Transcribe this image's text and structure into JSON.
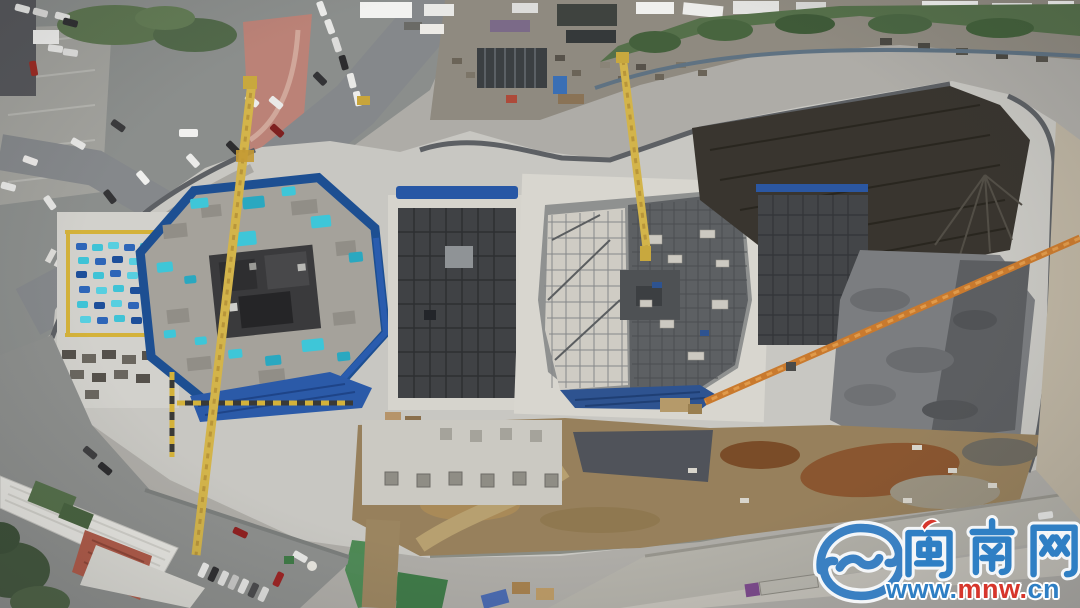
{
  "watermark": {
    "logo_icon": "mnw-swirl-logo",
    "site_name": "闽南网",
    "url_parts": {
      "www": "www.",
      "mnw": "mnw.",
      "cn": "cn"
    },
    "brand_blue": "#2f7fc4",
    "brand_red": "#d6362c"
  }
}
